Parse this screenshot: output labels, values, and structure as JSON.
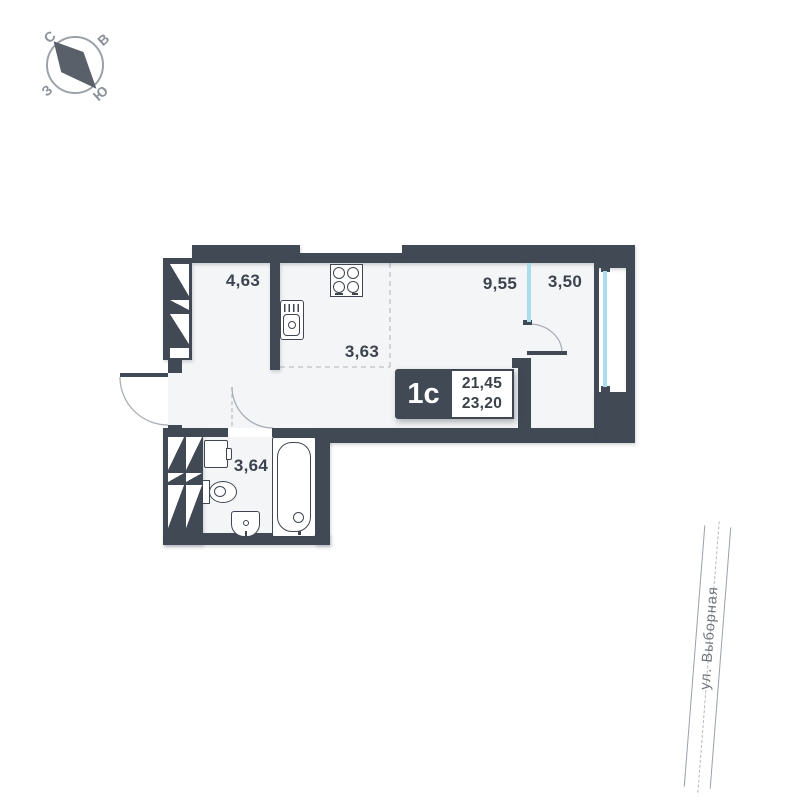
{
  "compass": {
    "north": "С",
    "east": "В",
    "south": "Ю",
    "west": "З"
  },
  "plan": {
    "unit": {
      "type_label": "1с",
      "area_main": "21,45",
      "area_total": "23,20"
    },
    "areas": {
      "hall": "4,63",
      "kitchen": "3,63",
      "living": "9,55",
      "balcony": "3,50",
      "bathroom": "3,64"
    },
    "fixtures": [
      "stove-icon",
      "kitchen-sink-icon",
      "washing-machine-icon",
      "toilet-icon",
      "washbasin-icon",
      "bathtub-icon"
    ]
  },
  "street": {
    "name": "ул. Выборная"
  },
  "colors": {
    "wall": "#414955",
    "floor": "#f3f5f7",
    "glass": "#a9dded",
    "label_text": "#3c434e",
    "road_line": "#9aa1a8",
    "compass_gray": "#8b9199",
    "needle_gray": "#59606a"
  }
}
